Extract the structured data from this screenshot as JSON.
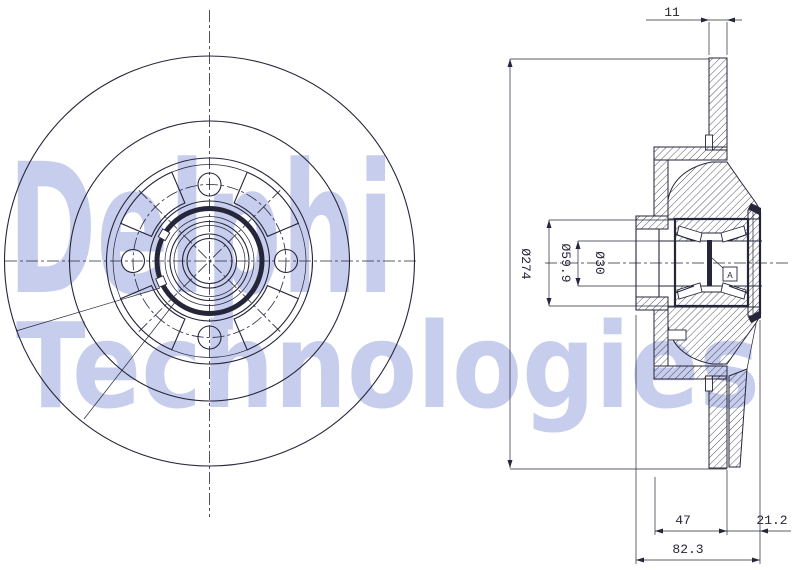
{
  "watermark": {
    "line1": "Delphi",
    "line2": "Technologies",
    "color": "#c7cdec"
  },
  "drawing": {
    "background": "#ffffff",
    "line_color": "#26263a",
    "dimensions": {
      "disc_thickness": "11",
      "outer_diameter": "Ø274",
      "bearing_outer_diameter": "Ø59.9",
      "bore_diameter": "Ø30",
      "hub_offset": "47",
      "bearing_protrusion": "21.2",
      "overall_depth": "82.3",
      "datum": "A"
    }
  }
}
